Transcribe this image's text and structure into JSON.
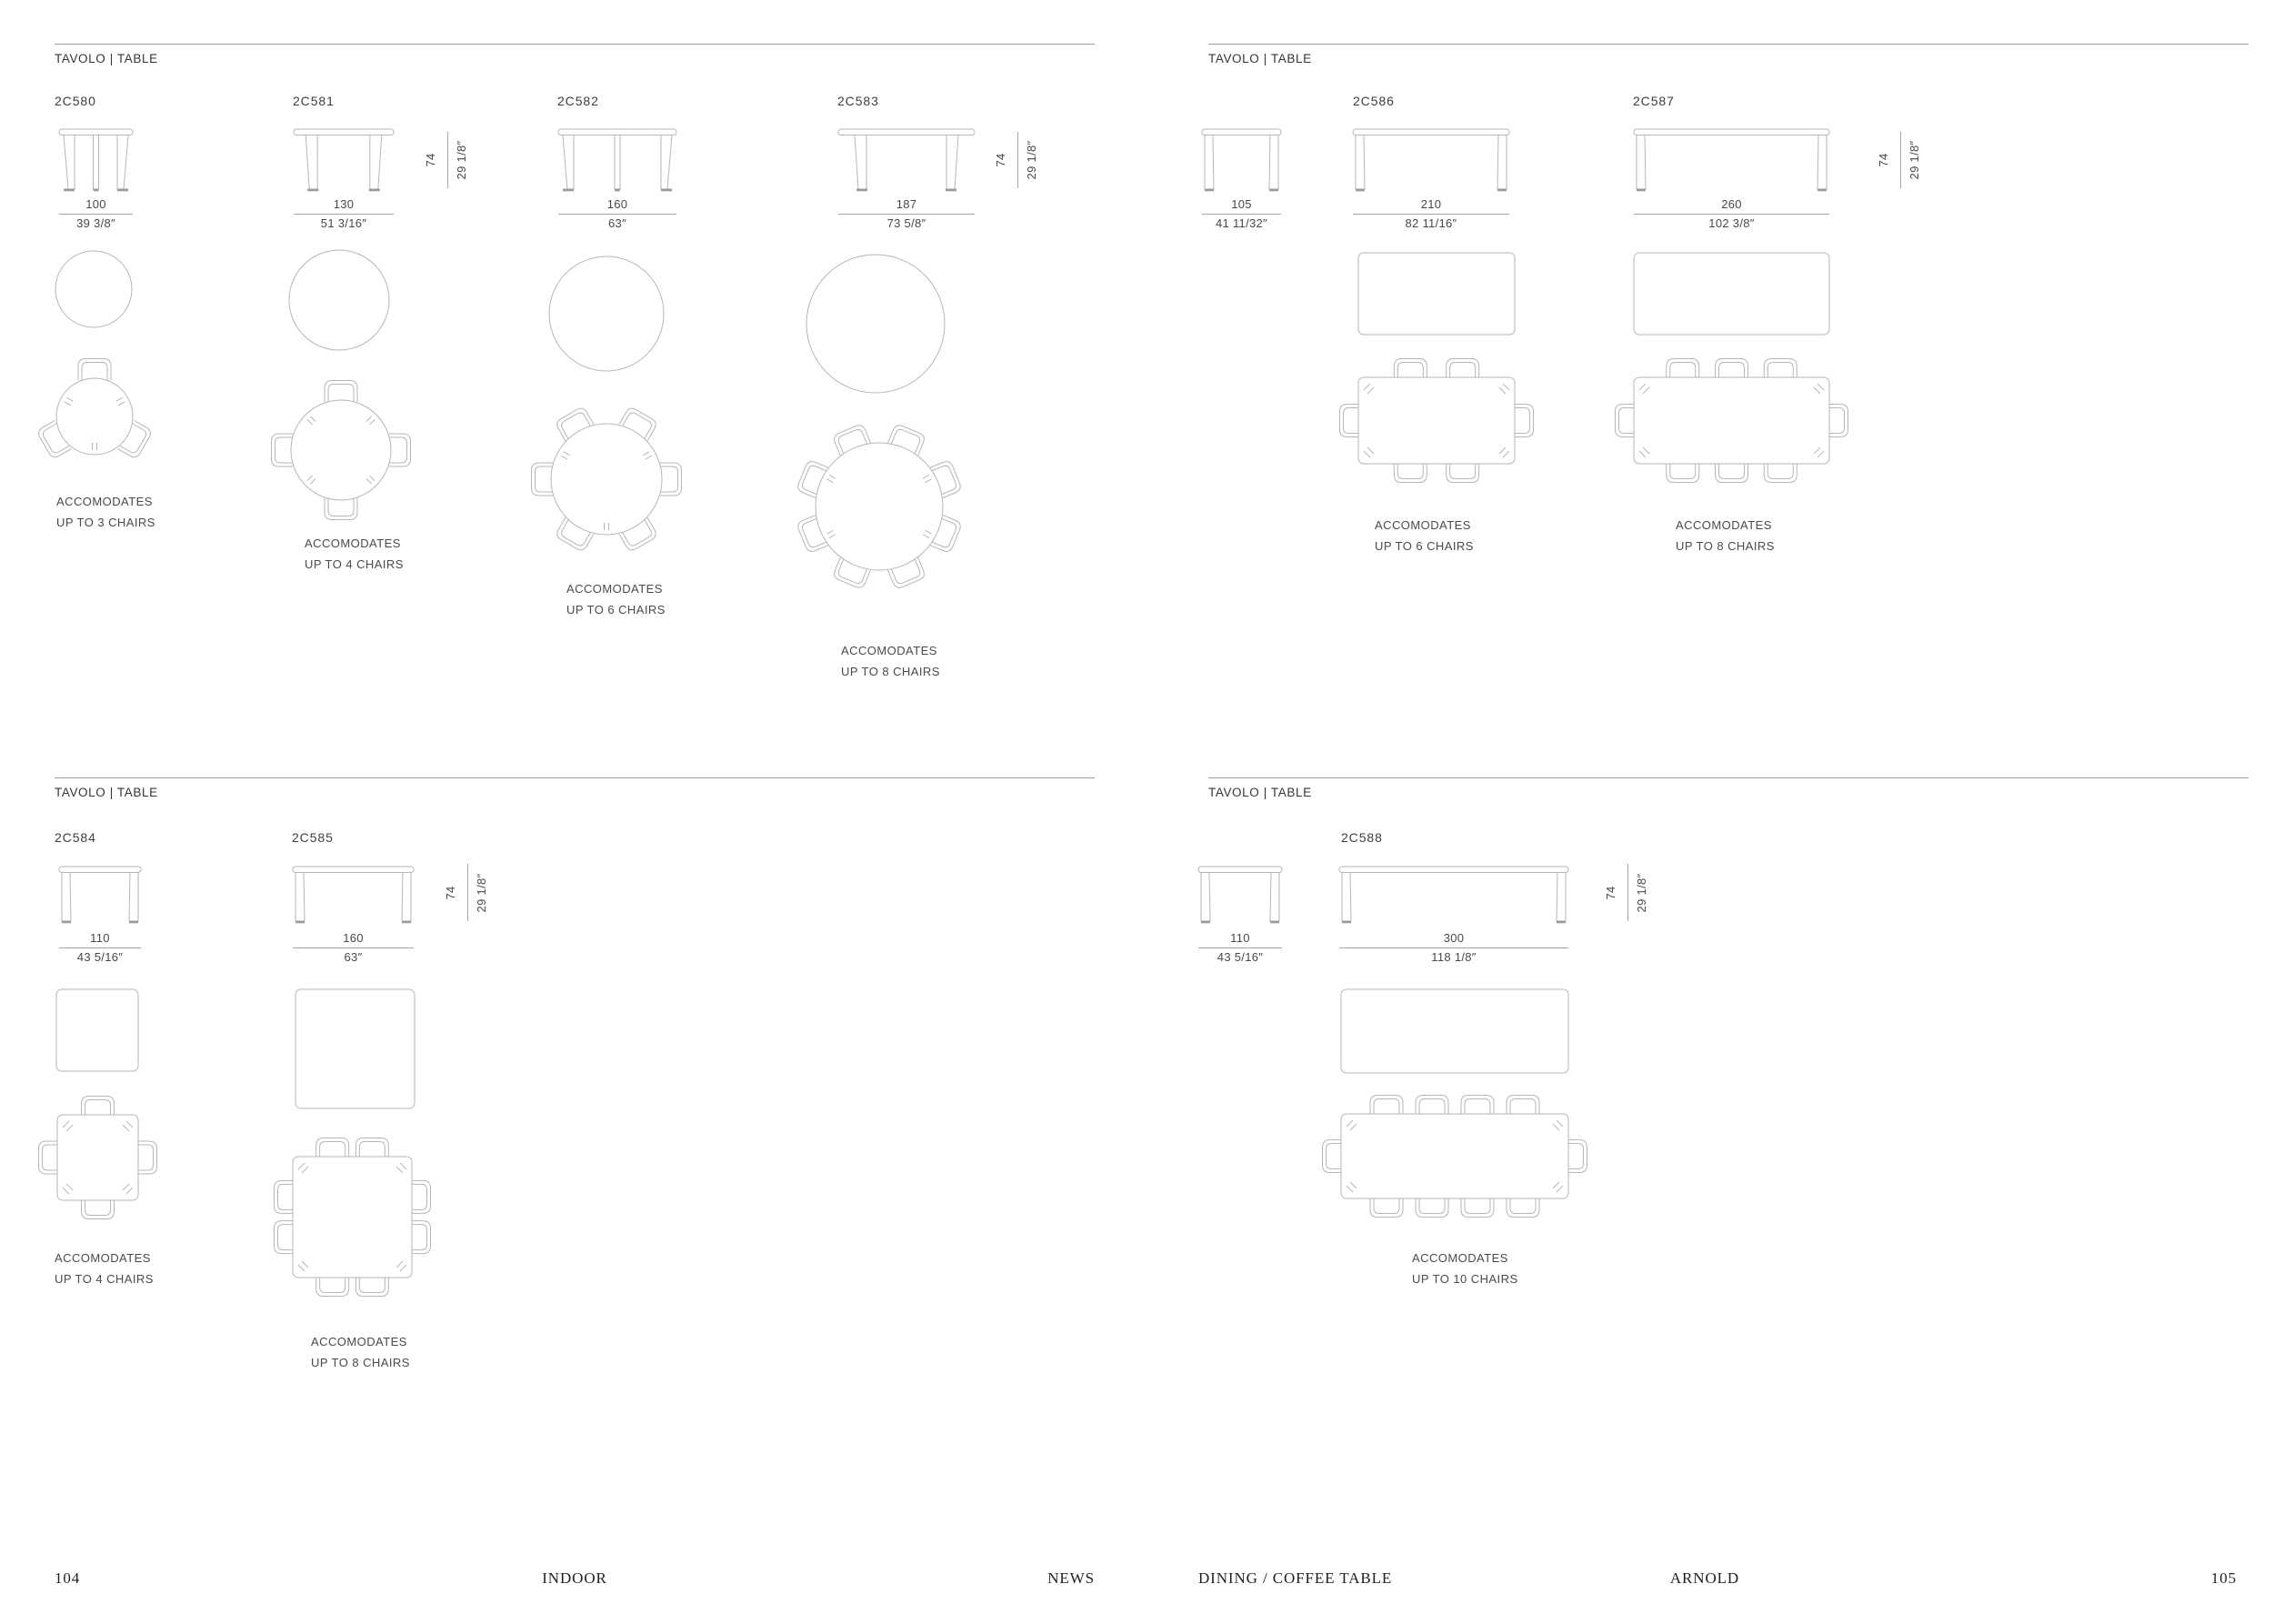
{
  "section_header": "TAVOLO | TABLE",
  "height": {
    "cm": "74",
    "in": "29 1/8″"
  },
  "products": [
    {
      "code": "2C580",
      "main_cm": "100",
      "main_in": "39 3/8″",
      "acc": [
        "ACCOMODATES",
        "UP TO 3 CHAIRS"
      ]
    },
    {
      "code": "2C581",
      "main_cm": "130",
      "main_in": "51 3/16″",
      "acc": [
        "ACCOMODATES",
        "UP TO 4 CHAIRS"
      ]
    },
    {
      "code": "2C582",
      "main_cm": "160",
      "main_in": "63″",
      "acc": [
        "ACCOMODATES",
        "UP TO 6 CHAIRS"
      ]
    },
    {
      "code": "2C583",
      "main_cm": "187",
      "main_in": "73 5/8″",
      "acc": [
        "ACCOMODATES",
        "UP TO 8 CHAIRS"
      ]
    },
    {
      "code": "2C586",
      "side_cm": "105",
      "side_in": "41 11/32″",
      "main_cm": "210",
      "main_in": "82 11/16″",
      "acc": [
        "ACCOMODATES",
        "UP TO 6 CHAIRS"
      ]
    },
    {
      "code": "2C587",
      "main_cm": "260",
      "main_in": "102 3/8″",
      "acc": [
        "ACCOMODATES",
        "UP TO 8 CHAIRS"
      ]
    },
    {
      "code": "2C584",
      "main_cm": "110",
      "main_in": "43 5/16″",
      "acc": [
        "ACCOMODATES",
        "UP TO 4 CHAIRS"
      ]
    },
    {
      "code": "2C585",
      "main_cm": "160",
      "main_in": "63″",
      "acc": [
        "ACCOMODATES",
        "UP TO 8 CHAIRS"
      ]
    },
    {
      "code": "2C588",
      "side_cm": "110",
      "side_in": "43 5/16″",
      "main_cm": "300",
      "main_in": "118 1/8″",
      "acc": [
        "ACCOMODATES",
        "UP TO 10 CHAIRS"
      ]
    }
  ],
  "footer": {
    "page_left": "104",
    "category_left": "INDOOR",
    "collection_tag": "NEWS",
    "category_right": "DINING / COFFEE TABLE",
    "product_name": "ARNOLD",
    "page_right": "105"
  }
}
